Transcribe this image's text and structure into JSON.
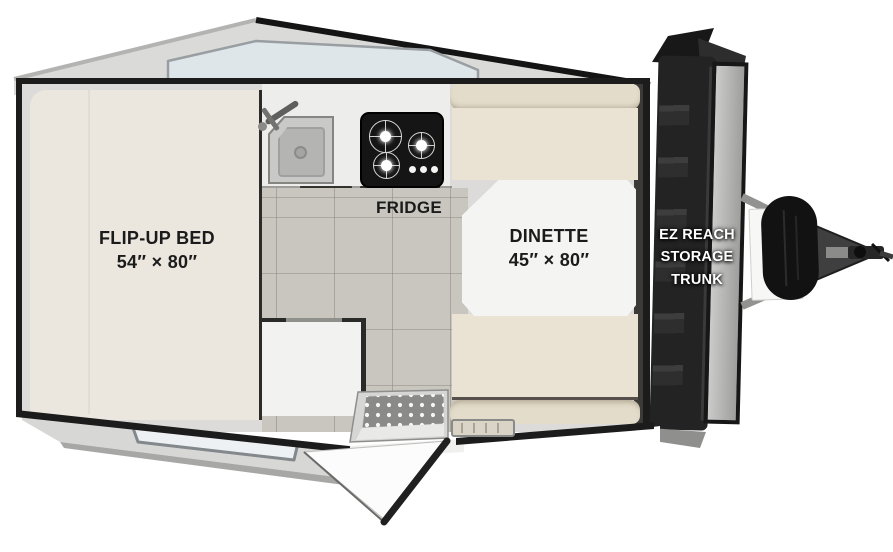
{
  "title": "A-frame pop-up camper floor plan",
  "floorplan": {
    "bed": {
      "label_line1": "FLIP-UP BED",
      "label_line2": "54″ × 80″"
    },
    "dinette": {
      "label_line1": "DINETTE",
      "label_line2": "45″ × 80″"
    },
    "fridge": {
      "label": "FRIDGE"
    },
    "storage_trunk": {
      "label_line1": "EZ REACH",
      "label_line2": "STORAGE",
      "label_line3": "TRUNK"
    }
  },
  "features": [
    "skylight-window",
    "flip-up-bed",
    "kitchen-sink",
    "cooktop-stove",
    "fridge",
    "tile-floor",
    "storage-cabinet",
    "dinette-table",
    "dinette-benches",
    "entry-step",
    "entry-door-open",
    "front-wall-window",
    "ez-reach-storage-trunk",
    "a-frame-tongue",
    "propane-tank-cover",
    "hitch-coupler"
  ],
  "colors": {
    "outline": "#1c1c1c",
    "bed_cushion": "#ebe7df",
    "dinette_cushion": "#eae3d3",
    "dinette_cushion_back": "#e4dcca",
    "table_top": "#f4f4f3",
    "counter": "#ededec",
    "floor_tile": "#c9c6c0",
    "stove": "#151515",
    "trunk": "#232323",
    "roof_panel": "#dadad8",
    "skylight": "#dfe6ea",
    "label_text": "#1b1b1b",
    "trunk_label_text": "#ffffff"
  }
}
